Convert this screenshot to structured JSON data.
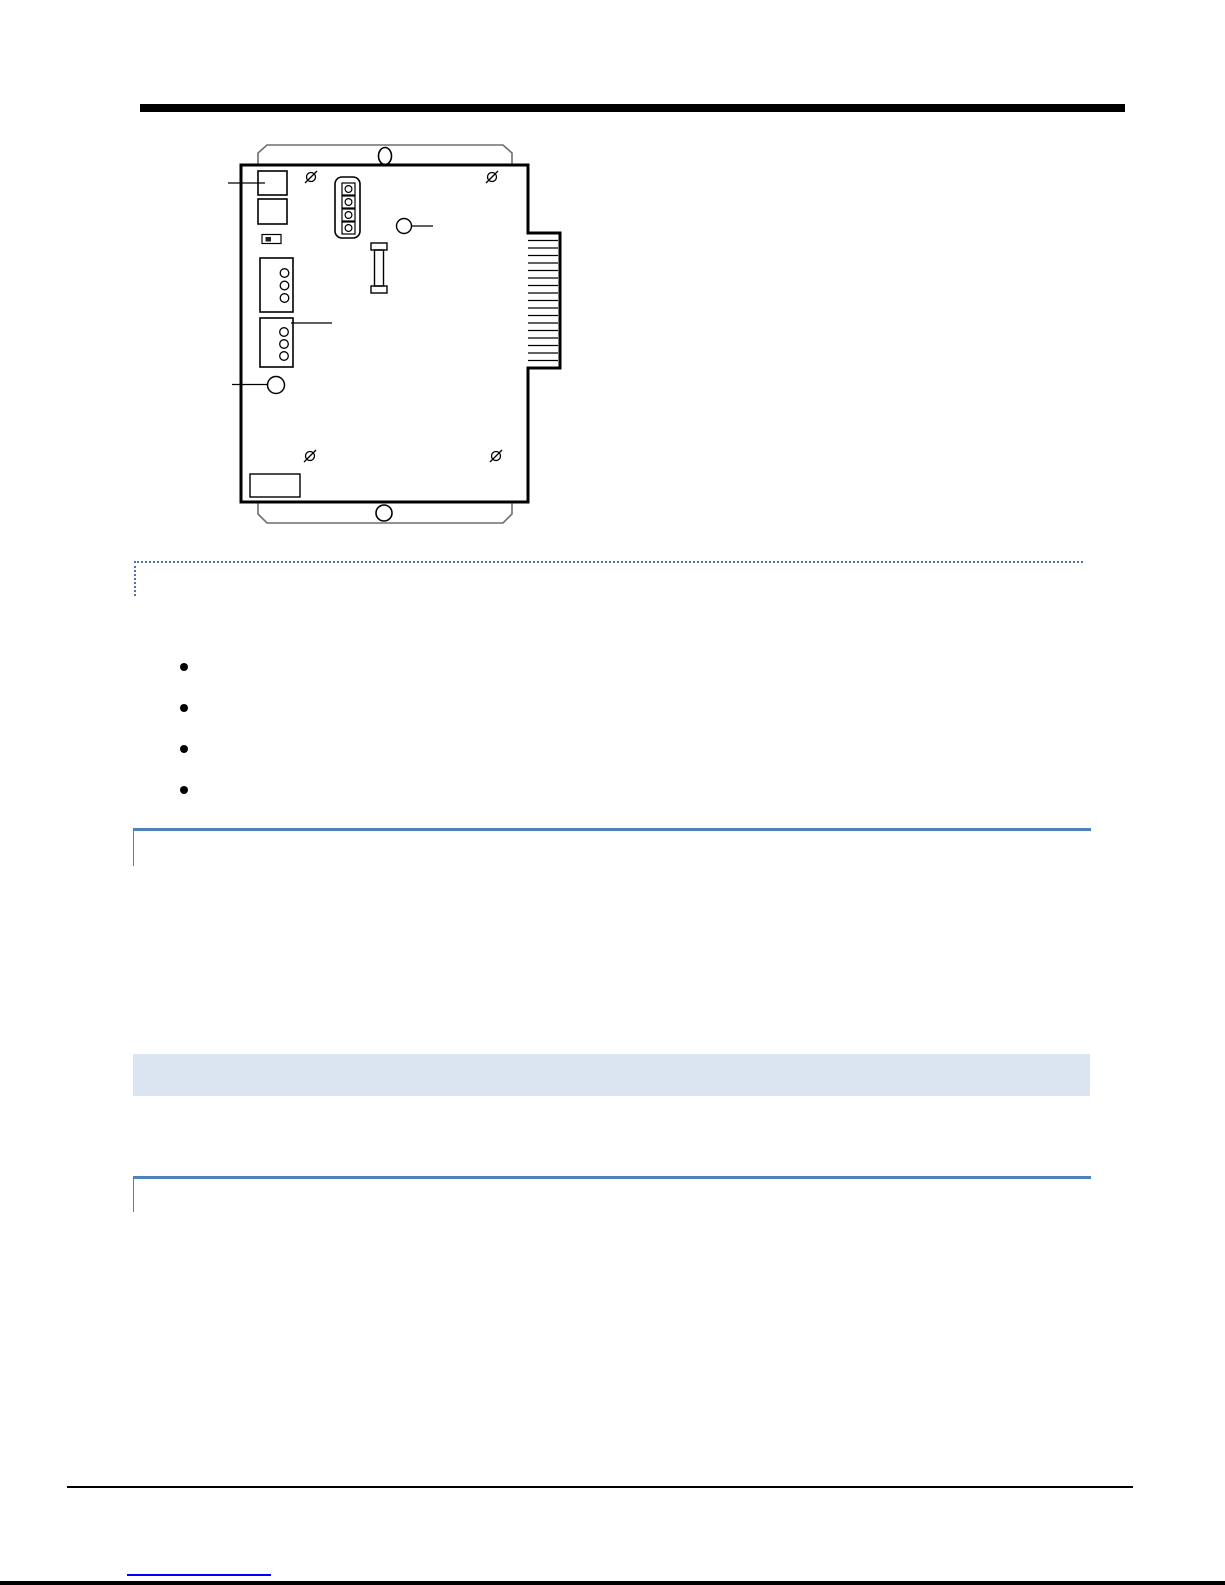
{
  "page": {
    "kind": "manual-page",
    "background": "#ffffff",
    "width_px": 1225,
    "height_px": 1585
  },
  "colors": {
    "page-bg": "#ffffff",
    "rule-black": "#000000",
    "dotted-blue": "#4a74b0",
    "accent-blue": "#4f81bd",
    "table-fill": "#dbe5f1",
    "link-blue": "#0000ff",
    "diagram-line": "#000000",
    "flange-line": "#6e6e6e"
  },
  "figure": {
    "type": "technical-line-drawing",
    "subject": "expansion-module-board-front-view",
    "components": [
      "mounting-flange-top",
      "mounting-flange-bottom",
      "board-outline",
      "corner-screw x4",
      "connector-block x2",
      "polarity-component",
      "jumper-header-4-pin",
      "test-point",
      "fuse",
      "terminal-block-3-pos x2",
      "led-indicator",
      "card-edge-connector-17-contacts",
      "label-area",
      "leader-line x4"
    ],
    "edge_contact_count": 17
  },
  "note_box": {
    "text": ""
  },
  "bullets": [
    "",
    "",
    "",
    ""
  ],
  "footer": {
    "link_text": ""
  }
}
